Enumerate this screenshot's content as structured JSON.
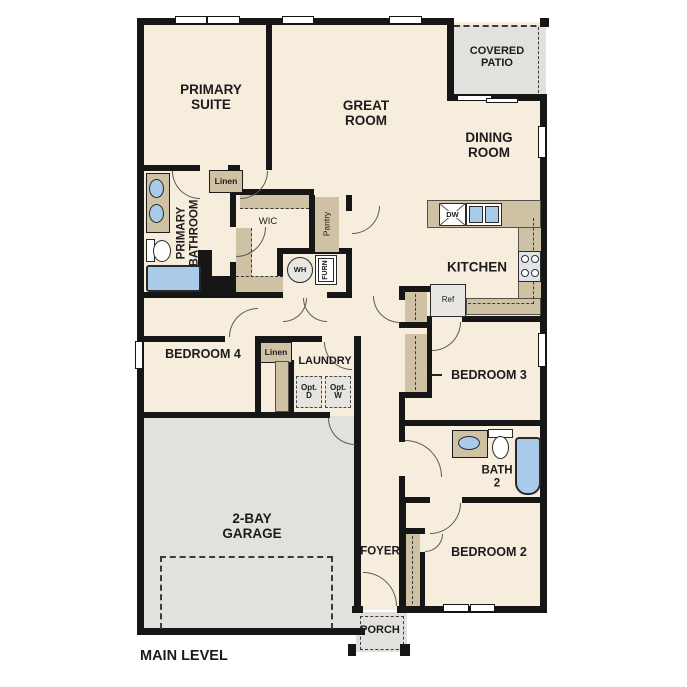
{
  "plan_title": "MAIN LEVEL",
  "colors": {
    "wall": "#161616",
    "floor": "#f6eddd",
    "cabinet_tan": "#cfc1a4",
    "concrete_gray": "#e2e1dd",
    "fixture_blue": "#a9cae8",
    "text": "#1c1c1c"
  },
  "labels": {
    "primary_suite": "PRIMARY\nSUITE",
    "great_room": "GREAT\nROOM",
    "covered_patio": "COVERED\nPATIO",
    "dining_room": "DINING\nROOM",
    "primary_bathroom": "PRIMARY\nBATHROOM",
    "linen_upper": "Linen",
    "wic": "WIC",
    "pantry": "Pantry",
    "water_heater": "WH",
    "furnace": "FURN",
    "kitchen": "KITCHEN",
    "dishwasher": "DW",
    "refrigerator": "Ref",
    "bedroom4": "BEDROOM 4",
    "linen_hall": "Linen",
    "laundry": "LAUNDRY",
    "opt_dryer": "Opt.\nD",
    "opt_washer": "Opt.\nW",
    "bedroom3": "BEDROOM 3",
    "bath2": "BATH\n2",
    "garage": "2-BAY\nGARAGE",
    "foyer": "FOYER",
    "bedroom2": "BEDROOM 2",
    "porch": "PORCH",
    "main_level": "MAIN LEVEL"
  }
}
